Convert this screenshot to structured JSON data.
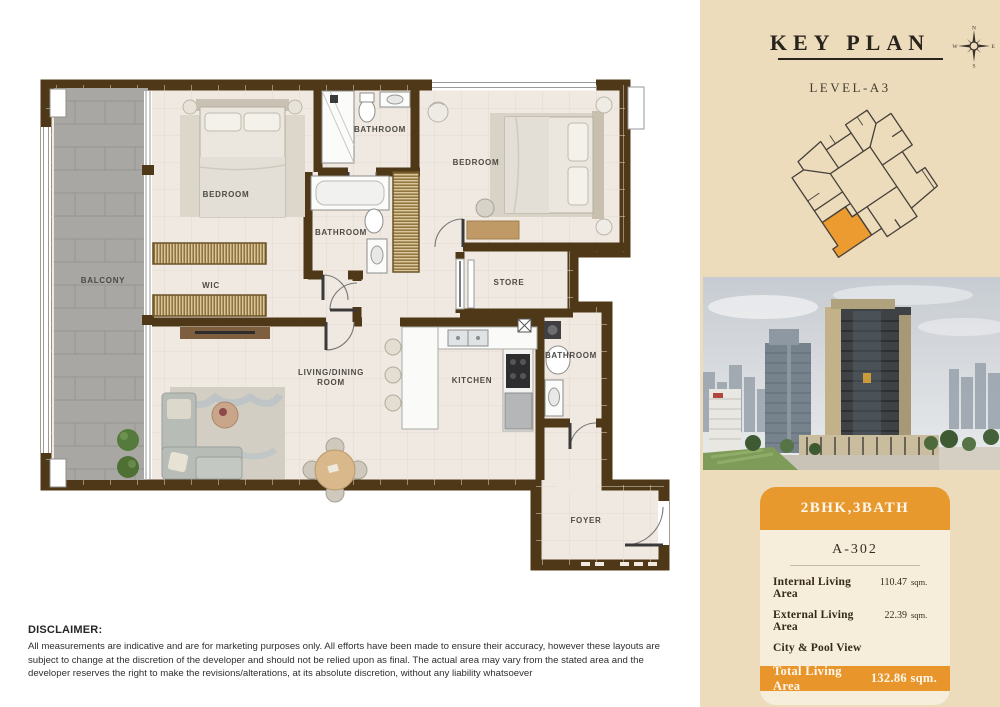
{
  "floor_plan": {
    "colors": {
      "wall": "#4e3817",
      "floor": "#f0e9e1",
      "balcony": "#a8a7a4",
      "wardrobe_wood": "#8a6a33",
      "label_text": "#4d4a45"
    },
    "rooms": [
      {
        "id": "balcony",
        "label": "BALCONY",
        "x": 73,
        "y": 228
      },
      {
        "id": "bedroom-1",
        "label": "BEDROOM",
        "x": 196,
        "y": 142
      },
      {
        "id": "bathroom-1",
        "label": "BATHROOM",
        "x": 350,
        "y": 77
      },
      {
        "id": "bedroom-2",
        "label": "BEDROOM",
        "x": 446,
        "y": 110
      },
      {
        "id": "bathroom-2",
        "label": "BATHROOM",
        "x": 311,
        "y": 180
      },
      {
        "id": "wic",
        "label": "WIC",
        "x": 181,
        "y": 233
      },
      {
        "id": "store",
        "label": "STORE",
        "x": 479,
        "y": 230
      },
      {
        "id": "living-dining",
        "label": "LIVING/DINING\nROOM",
        "x": 301,
        "y": 320
      },
      {
        "id": "kitchen",
        "label": "KITCHEN",
        "x": 442,
        "y": 328
      },
      {
        "id": "bathroom-3",
        "label": "BATHROOM",
        "x": 541,
        "y": 303
      },
      {
        "id": "foyer",
        "label": "FOYER",
        "x": 556,
        "y": 468
      }
    ]
  },
  "key_plan": {
    "title": "KEY PLAN",
    "level": "LEVEL-A3",
    "compass": {
      "north": "N",
      "east": "E",
      "south": "S",
      "west": "W"
    },
    "highlight_color": "#eb9b2f"
  },
  "unit_card": {
    "type_badge": "2BHK,3BATH",
    "unit_number": "A-302",
    "rows": [
      {
        "label": "Internal Living Area",
        "value": "110.47",
        "unit": "sqm."
      },
      {
        "label": "External Living Area",
        "value": "22.39",
        "unit": "sqm."
      },
      {
        "label": "City & Pool View",
        "value": "",
        "unit": ""
      }
    ],
    "total": {
      "label": "Total Living Area",
      "value": "132.86",
      "unit": "sqm."
    },
    "accent_color": "#e8962b"
  },
  "disclaimer": {
    "heading": "DISCLAIMER:",
    "body": "All measurements are indicative and are for marketing purposes only. All efforts have been made to ensure their accuracy, however these layouts are subject to change at the discretion of the developer and should not be relied upon as final. The actual area may vary from the stated area and the developer reserves the right to make the revisions/alterations, at its absolute discretion, without any liability whatsoever"
  }
}
